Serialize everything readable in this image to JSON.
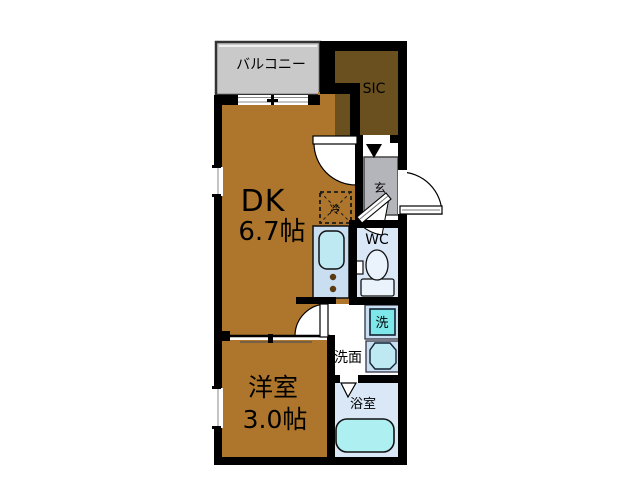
{
  "plan": {
    "type": "apartment-floor-plan",
    "rooms": {
      "balcony": {
        "label": "バルコニー"
      },
      "sic": {
        "label": "SIC"
      },
      "dk": {
        "label": "DK",
        "size": "6.7帖"
      },
      "genkan": {
        "label": "玄"
      },
      "wc": {
        "label": "WC"
      },
      "washroom": {
        "label": "洗面"
      },
      "washing_machine": {
        "label": "洗"
      },
      "bathroom": {
        "label": "浴室"
      },
      "western_room": {
        "label": "洋室",
        "size": "3.0帖"
      },
      "refrigerator": {
        "label": "冷"
      }
    },
    "colors": {
      "wall": "#000000",
      "room_brown": "#ae762c",
      "sic_brown": "#69501e",
      "balcony_gray": "#c9c9c9",
      "genkan_gray": "#b4b4bb",
      "fixture_blue": "#c9def1",
      "floor_blue": "#d9e7f6",
      "washer_cyan": "#7de7ea",
      "tub_cyan": "#aeeff2",
      "sink_cyan": "#bfe9f2",
      "toilet_white": "#eaf2fb",
      "burner_dot": "#5a3a10"
    }
  }
}
